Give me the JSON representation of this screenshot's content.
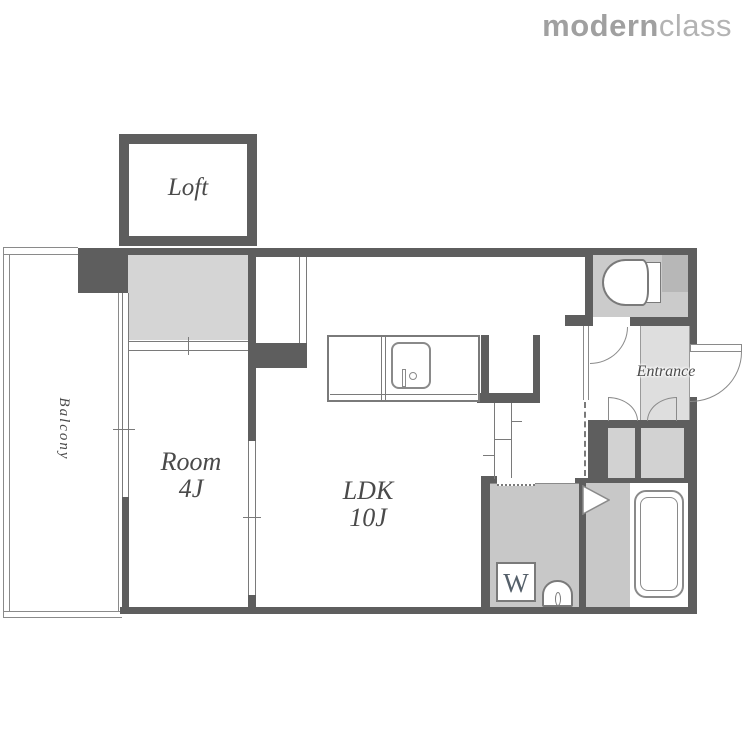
{
  "brand": {
    "name_bold": "modern",
    "name_light": "class"
  },
  "plan": {
    "rooms": {
      "loft_label": "Loft",
      "balcony_label": "Balcony",
      "room_line1": "Room",
      "room_line2": "4J",
      "ldk_line1": "LDK",
      "ldk_line2": "10J",
      "entrance_label": "Entrance"
    },
    "fixtures": {
      "washing_machine_label": "W",
      "icons": [
        "toilet-icon",
        "bathtub-icon",
        "kitchen-sink-icon",
        "washbasin-icon",
        "door-swing-arc-icon",
        "sliding-door-icon"
      ]
    }
  },
  "colors": {
    "wall": "#5e5e5e",
    "fill_light": "#d5d5d5",
    "fill_mid": "#c8c8c8",
    "fill_toilet": "#cbcbcb",
    "fill_entrance": "#dedede",
    "fill_pipe_space": "#b7b7b7",
    "outline": "#7a7a7a",
    "text": "#4a4a4a",
    "logo_gray": "#a0a0a0"
  }
}
